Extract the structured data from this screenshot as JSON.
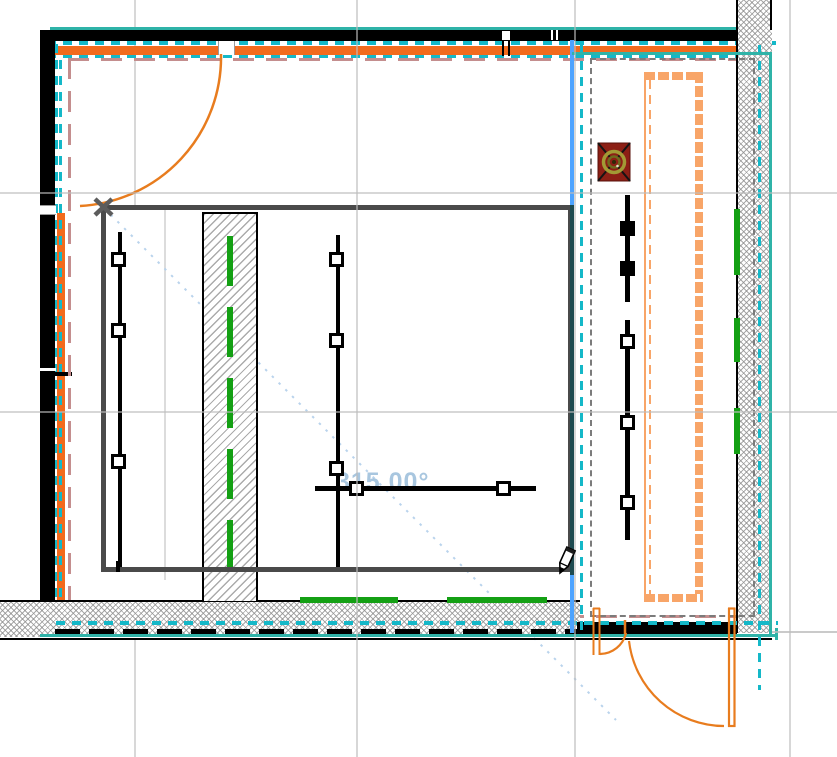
{
  "app": {
    "type": "cad-floor-plan-canvas",
    "view": "2d-plan"
  },
  "readout": {
    "angle": "315.00°",
    "color": "#9fc0dc"
  },
  "cursor": {
    "tool": "pencil-draw-cursor"
  },
  "selection": {
    "state": "walls-selected",
    "highlight_dash_color": "#14b8c8",
    "highlight_line_color": "#2fb3a8",
    "reference_line_color": "#4da3ff",
    "offset_guide_color": "#c48e8e",
    "marquee_dash_color": "#7b7b7b"
  },
  "plan": {
    "walls": [
      {
        "name": "top-exterior-wall",
        "fill": "#000000",
        "insulation_color": "#f26b1d"
      },
      {
        "name": "left-exterior-wall",
        "fill": "#000000",
        "insulation_color": "#f26b1d"
      },
      {
        "name": "right-exterior-wall",
        "fill": "hatch"
      },
      {
        "name": "bottom-exterior-wall",
        "fill": "hatch"
      },
      {
        "name": "interior-column-wall",
        "fill": "hatch"
      }
    ],
    "doors": [
      {
        "name": "entry-door-top-left",
        "swing": "quarter-arc",
        "color": "#e87c1e"
      },
      {
        "name": "small-exterior-door-bottom",
        "swing": "quarter-arc",
        "color": "#e87c1e"
      },
      {
        "name": "large-exterior-door-bottom-right",
        "swing": "quarter-arc",
        "color": "#e87c1e"
      }
    ],
    "fixtures": [
      {
        "name": "floor-drain-symbol",
        "body_color": "#8c1f15",
        "ring_color": "#a29a35"
      },
      {
        "name": "counter-outline",
        "color": "#f8a568"
      }
    ],
    "annotation_lines": [
      {
        "name": "left-riser-line",
        "hotspots": 3
      },
      {
        "name": "middle-riser-line",
        "hotspots": 3
      },
      {
        "name": "horizontal-riser-line",
        "hotspots": 2
      },
      {
        "name": "right-riser-line",
        "hotspots": 5
      }
    ],
    "green_marks_color": "#14a014",
    "room_boundary_color": "#4a4a4a",
    "grid_color": "#bdbdbd"
  }
}
